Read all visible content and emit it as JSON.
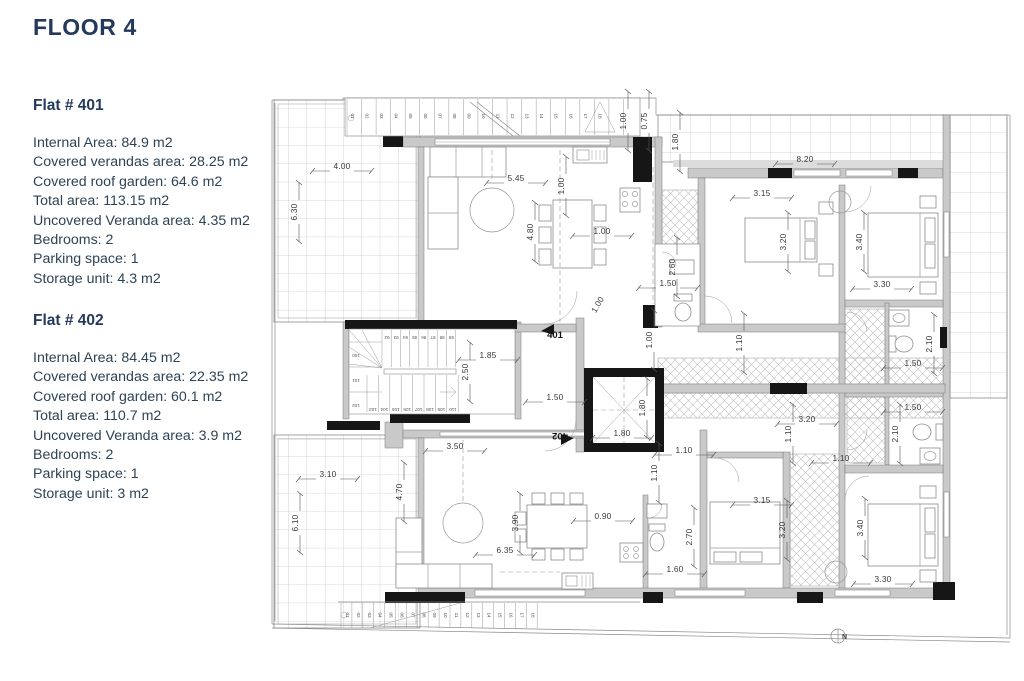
{
  "page": {
    "title": "FLOOR 4"
  },
  "flats": [
    {
      "name": "Flat # 401",
      "specs": [
        "Internal Area: 84.9 m2",
        "Covered verandas area: 28.25 m2",
        "Covered roof garden: 64.6 m2",
        "Total area: 113.15 m2",
        "Uncovered Veranda area: 4.35 m2",
        "Bedrooms: 2",
        "Parking space: 1",
        "Storage unit: 4.3 m2"
      ]
    },
    {
      "name": "Flat # 402",
      "specs": [
        "Internal Area: 84.45 m2",
        "Covered verandas area: 22.35 m2",
        "Covered roof garden: 60.1 m2",
        "Total area: 110.7 m2",
        "Uncovered Veranda area: 3.9 m2",
        "Bedrooms: 2",
        "Parking space: 1",
        "Storage unit: 3 m2"
      ]
    }
  ],
  "plan": {
    "north_label": "N",
    "units": [
      {
        "t": "401",
        "x": 285,
        "y": 266,
        "r": 0
      },
      {
        "t": "402",
        "x": 290,
        "y": 361,
        "r": 180
      }
    ],
    "dimensions": [
      {
        "t": "4.00",
        "x": 72,
        "y": 97,
        "r": 0
      },
      {
        "t": "6.30",
        "x": 27,
        "y": 140,
        "r": 90
      },
      {
        "t": "5.45",
        "x": 246,
        "y": 109,
        "r": 0
      },
      {
        "t": "1.00",
        "x": 294,
        "y": 114,
        "r": 90
      },
      {
        "t": "4.80",
        "x": 263,
        "y": 160,
        "r": 90
      },
      {
        "t": "1.00",
        "x": 332,
        "y": 162,
        "r": 0
      },
      {
        "t": "1.00",
        "x": 330,
        "y": 234,
        "r": 60
      },
      {
        "t": "1.00",
        "x": 356,
        "y": 49,
        "r": 90
      },
      {
        "t": "0.75",
        "x": 377,
        "y": 49,
        "r": 90
      },
      {
        "t": "1.80",
        "x": 408,
        "y": 70,
        "r": 90
      },
      {
        "t": "8.20",
        "x": 535,
        "y": 90,
        "r": 0
      },
      {
        "t": "3.15",
        "x": 492,
        "y": 124,
        "r": 0
      },
      {
        "t": "3.20",
        "x": 516,
        "y": 170,
        "r": 90
      },
      {
        "t": "3.40",
        "x": 592,
        "y": 170,
        "r": 90
      },
      {
        "t": "3.30",
        "x": 612,
        "y": 215,
        "r": 0
      },
      {
        "t": "2.60",
        "x": 405,
        "y": 195,
        "r": 90
      },
      {
        "t": "1.50",
        "x": 398,
        "y": 214,
        "r": 0
      },
      {
        "t": "1.00",
        "x": 382,
        "y": 268,
        "r": 90
      },
      {
        "t": "1.10",
        "x": 472,
        "y": 271,
        "r": 90
      },
      {
        "t": "2.10",
        "x": 662,
        "y": 272,
        "r": 90
      },
      {
        "t": "1.50",
        "x": 643,
        "y": 294,
        "r": 0
      },
      {
        "t": "1.50",
        "x": 643,
        "y": 338,
        "r": 0
      },
      {
        "t": "2.10",
        "x": 628,
        "y": 362,
        "r": 90
      },
      {
        "t": "1.85",
        "x": 218,
        "y": 286,
        "r": 0
      },
      {
        "t": "2.50",
        "x": 198,
        "y": 300,
        "r": 90
      },
      {
        "t": "1.50",
        "x": 285,
        "y": 328,
        "r": 0
      },
      {
        "t": "1.80",
        "x": 375,
        "y": 336,
        "r": 90
      },
      {
        "t": "1.80",
        "x": 352,
        "y": 364,
        "r": 0
      },
      {
        "t": "1.10",
        "x": 414,
        "y": 381,
        "r": 0
      },
      {
        "t": "1.10",
        "x": 387,
        "y": 401,
        "r": 90
      },
      {
        "t": "3.20",
        "x": 537,
        "y": 350,
        "r": 0
      },
      {
        "t": "1.10",
        "x": 521,
        "y": 362,
        "r": 90
      },
      {
        "t": "1.10",
        "x": 571,
        "y": 389,
        "r": 0
      },
      {
        "t": "3.10",
        "x": 58,
        "y": 405,
        "r": 0
      },
      {
        "t": "6.10",
        "x": 28,
        "y": 451,
        "r": 90
      },
      {
        "t": "3.50",
        "x": 185,
        "y": 377,
        "r": 0
      },
      {
        "t": "4.70",
        "x": 132,
        "y": 420,
        "r": 90
      },
      {
        "t": "3.90",
        "x": 248,
        "y": 451,
        "r": 90
      },
      {
        "t": "6.35",
        "x": 235,
        "y": 481,
        "r": 0
      },
      {
        "t": "0.90",
        "x": 333,
        "y": 447,
        "r": 0
      },
      {
        "t": "2.70",
        "x": 422,
        "y": 465,
        "r": 90
      },
      {
        "t": "1.60",
        "x": 405,
        "y": 500,
        "r": 0
      },
      {
        "t": "3.15",
        "x": 492,
        "y": 431,
        "r": 0
      },
      {
        "t": "3.20",
        "x": 515,
        "y": 458,
        "r": 90
      },
      {
        "t": "3.40",
        "x": 593,
        "y": 456,
        "r": 90
      },
      {
        "t": "3.30",
        "x": 613,
        "y": 510,
        "r": 0
      }
    ],
    "steps": {
      "top": [
        "01",
        "02",
        "03",
        "04",
        "05",
        "06",
        "07",
        "08",
        "09",
        "10",
        "11",
        "12",
        "13",
        "14",
        "15",
        "16",
        "17",
        "18"
      ],
      "bottom": [
        "01",
        "02",
        "03",
        "04",
        "05",
        "06",
        "07",
        "08",
        "09",
        "10",
        "11",
        "12",
        "13",
        "14",
        "15",
        "16",
        "17",
        "18"
      ],
      "int_upper": [
        "92",
        "93",
        "94",
        "95",
        "96",
        "97",
        "98",
        "99"
      ],
      "int_side": [
        "100",
        "101",
        "102"
      ],
      "int_lower": [
        "103",
        "104",
        "105",
        "106",
        "107",
        "108",
        "109",
        "110"
      ]
    }
  }
}
